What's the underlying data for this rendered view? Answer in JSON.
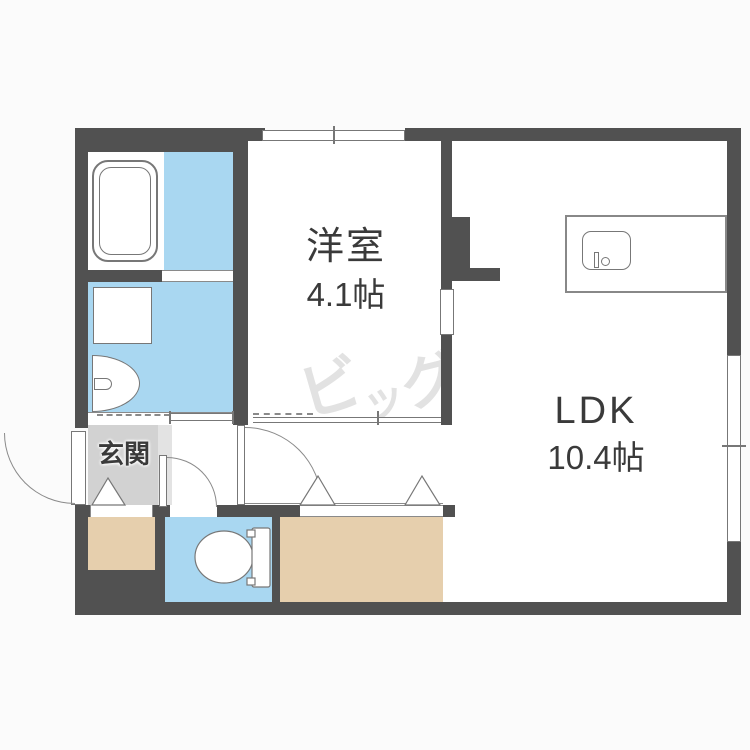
{
  "plan": {
    "rooms": {
      "western_room": {
        "name": "洋室",
        "area": "4.1帖"
      },
      "ldk": {
        "name": "LDK",
        "area": "10.4帖"
      },
      "entrance": {
        "name": "玄関"
      }
    },
    "watermark": {
      "text": "ビッグ",
      "char1": "ビ",
      "char2": "ッ",
      "char3": "グ"
    },
    "fixtures": [
      "bathtub",
      "washing-machine-pan",
      "washbasin",
      "toilet",
      "kitchen-counter",
      "kitchen-sink",
      "entry-door",
      "toilet-door",
      "hall-door",
      "sliding-doors",
      "closet-folding-doors",
      "windows"
    ],
    "colors": {
      "wall": "#515151",
      "wet_area": "#a9d7f1",
      "closet": "#e6cfad",
      "entrance_floor": "#d2d2d2",
      "entrance_step": "#e3e3e3",
      "outline": "#777777",
      "line": "#8a8a8a",
      "text": "#3a3a3a",
      "watermark": "#e2e2e2",
      "background": "#fbfbfb"
    }
  }
}
